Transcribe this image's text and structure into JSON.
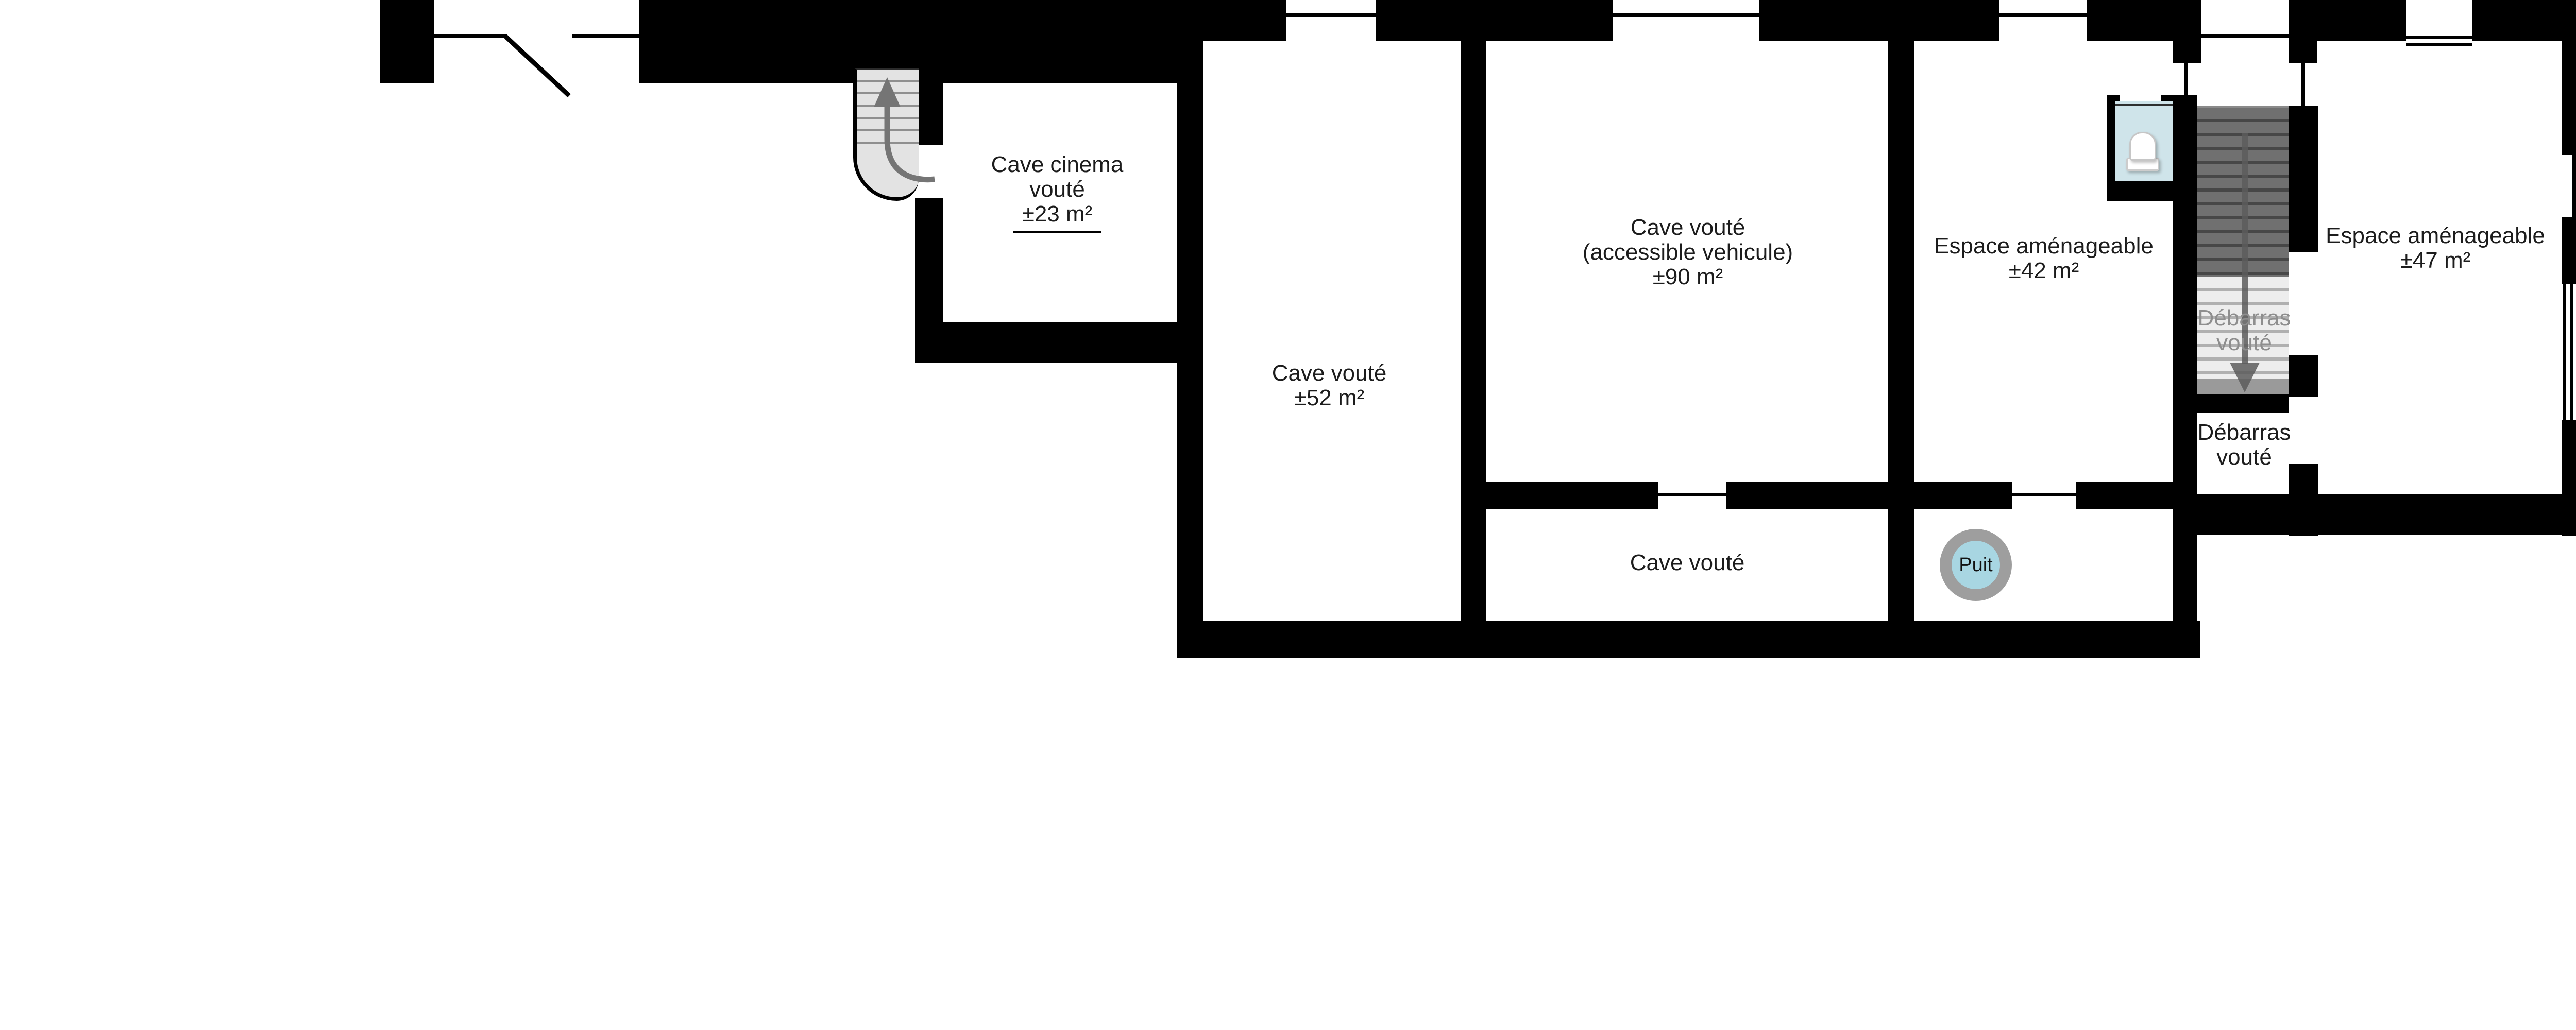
{
  "plan": {
    "type": "basement-floor-plan",
    "rooms": {
      "cave_cinema": {
        "lines": [
          "Cave cinema",
          "vouté",
          "±23 m²"
        ],
        "area_underlined": true
      },
      "cave_52": {
        "lines": [
          "Cave vouté",
          "±52 m²"
        ]
      },
      "cave_90": {
        "lines": [
          "Cave vouté",
          "(accessible vehicule)",
          "±90 m²"
        ]
      },
      "espace_42": {
        "lines": [
          "Espace aménageable",
          "±42 m²"
        ]
      },
      "espace_47": {
        "lines": [
          "Espace aménageable",
          "±47 m²"
        ]
      },
      "debarras_on_stairs": {
        "lines": [
          "Débarras",
          "vouté"
        ],
        "color": "#8e8e8e"
      },
      "debarras": {
        "lines": [
          "Débarras",
          "vouté"
        ]
      },
      "cave_bottom": {
        "lines": [
          "Cave vouté"
        ]
      }
    },
    "well_label": "Puit",
    "icons": [
      "stairs-up-icon",
      "stairs-down-icon",
      "toilet-icon",
      "well-icon",
      "door-swing-icon",
      "window-icon"
    ],
    "colors": {
      "wall": "#000000",
      "text": "#1c1c1c",
      "text_gray": "#8e8e8e",
      "stair_dark": "#707070",
      "stair_light": "#ededed",
      "toilet_blue": "#cfe4ea",
      "well_fill": "#a8d6e2",
      "well_ring": "#9e9e9e"
    }
  }
}
